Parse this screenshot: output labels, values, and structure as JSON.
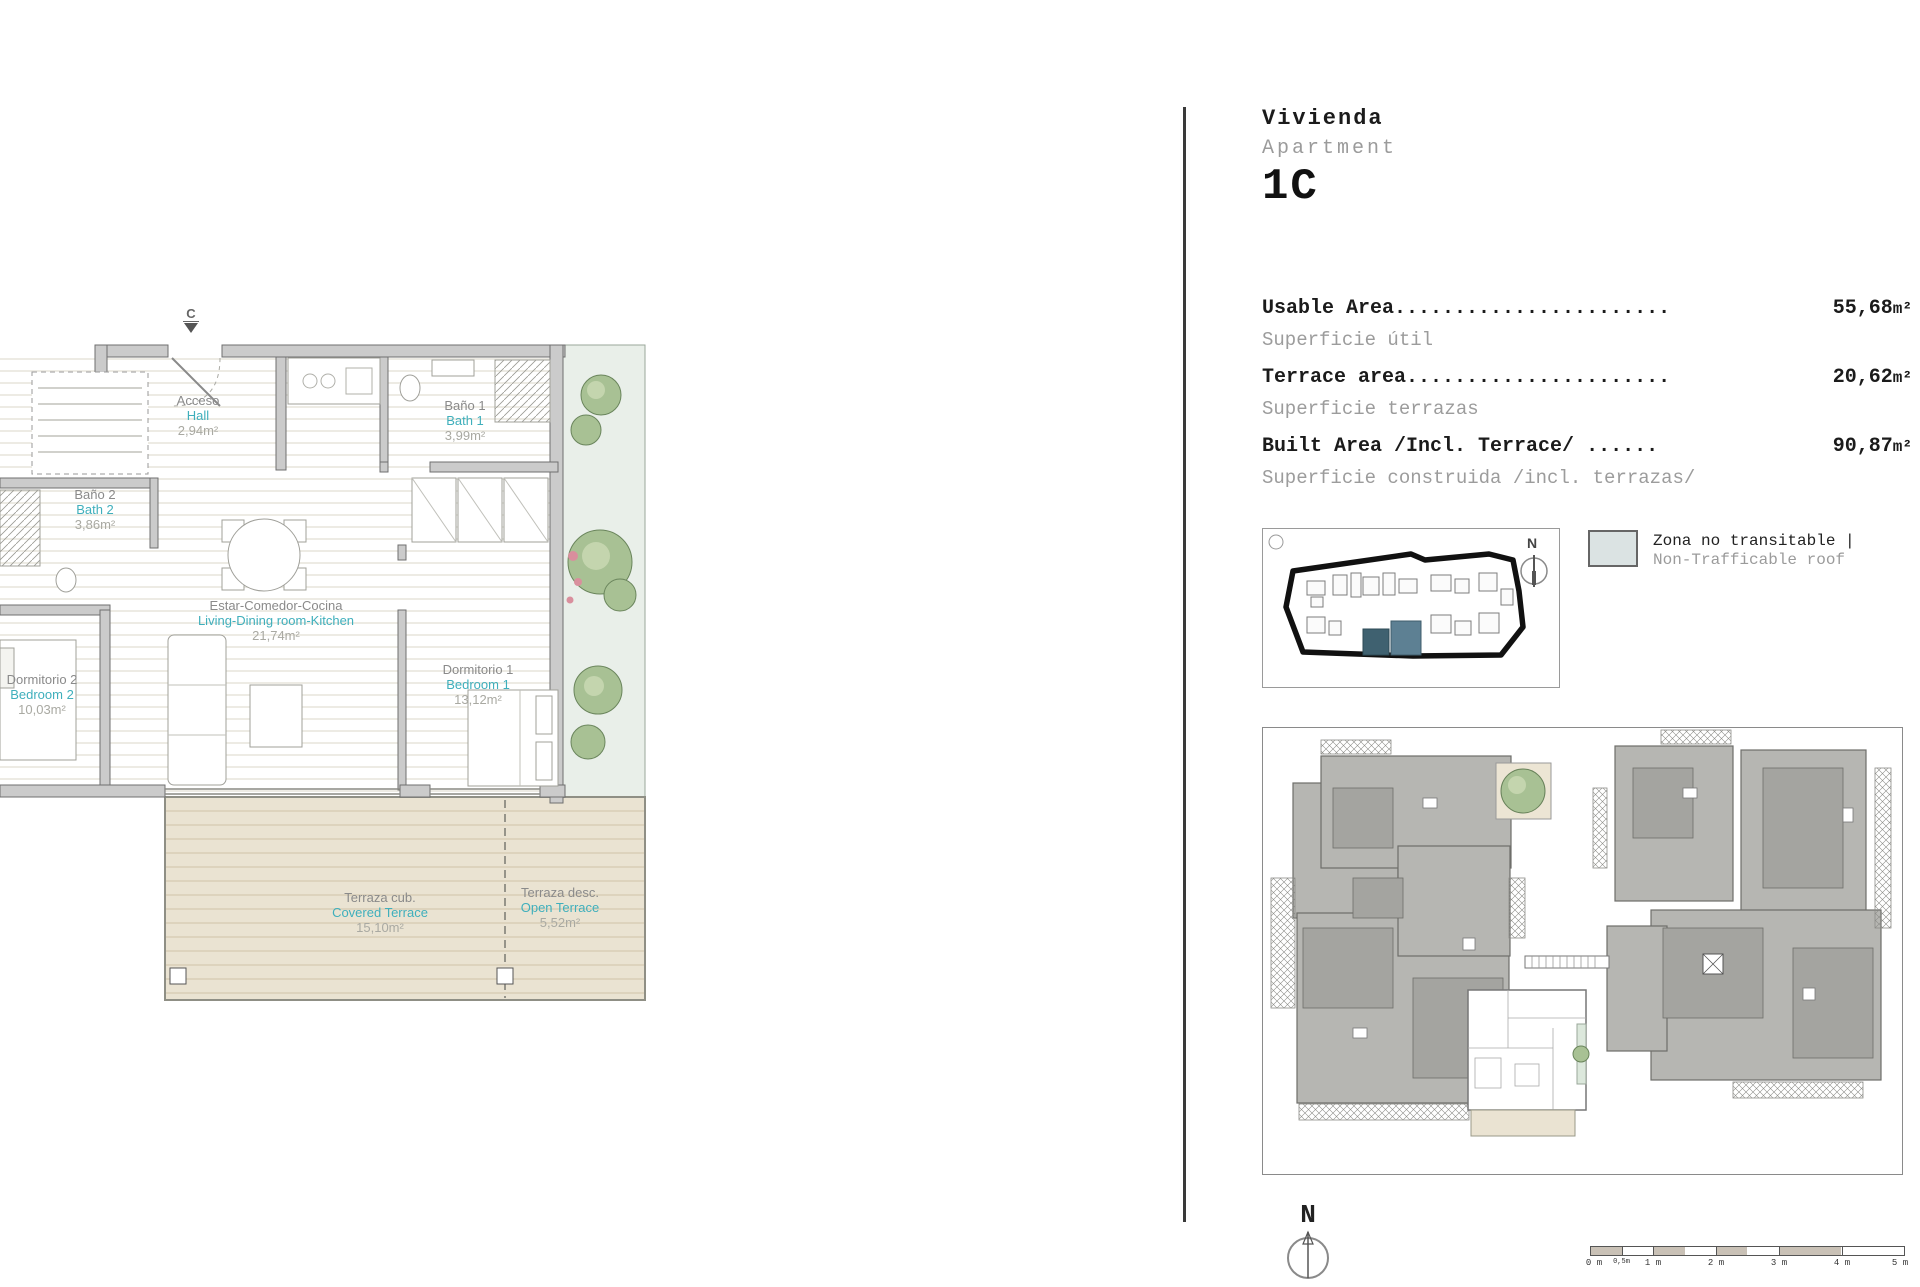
{
  "header": {
    "title_es": "Vivienda",
    "title_en": "Apartment",
    "unit_id": "1C"
  },
  "areas": [
    {
      "label_en": "Usable Area",
      "leader": ".......................",
      "value": "55,68",
      "unit": "m²",
      "label_es": "Superficie útil"
    },
    {
      "label_en": "Terrace area",
      "leader": "......................",
      "value": "20,62",
      "unit": "m²",
      "label_es": "Superficie terrazas"
    },
    {
      "label_en": "Built Area /Incl. Terrace/",
      "leader": "......",
      "value": "90,87",
      "unit": "m²",
      "label_es": "Superficie construida /incl. terrazas/"
    }
  ],
  "legend": {
    "line_es": "Zona no transitable |",
    "line_en": "Non-Trafficable roof",
    "swatch_color": "#dbe3e3"
  },
  "floor_plan": {
    "section_marker": "C",
    "rooms": [
      {
        "name_es": "Acceso",
        "name_en": "Hall",
        "area": "2,94m²"
      },
      {
        "name_es": "Baño 1",
        "name_en": "Bath 1",
        "area": "3,99m²"
      },
      {
        "name_es": "Baño 2",
        "name_en": "Bath 2",
        "area": "3,86m²"
      },
      {
        "name_es": "Estar-Comedor-Cocina",
        "name_en": "Living-Dining room-Kitchen",
        "area": "21,74m²"
      },
      {
        "name_es": "Dormitorio 2",
        "name_en": "Bedroom 2",
        "area": "10,03m²"
      },
      {
        "name_es": "Dormitorio 1",
        "name_en": "Bedroom 1",
        "area": "13,12m²"
      },
      {
        "name_es": "Terraza cub.",
        "name_en": "Covered Terrace",
        "area": "15,10m²"
      },
      {
        "name_es": "Terraza desc.",
        "name_en": "Open Terrace",
        "area": "5,52m²"
      }
    ]
  },
  "site_map": {
    "north": "N"
  },
  "compass": {
    "north": "N"
  },
  "scale_bar": {
    "labels": [
      "0 m",
      "0,5m",
      "1 m",
      "2 m",
      "3 m",
      "4 m",
      "5 m"
    ]
  },
  "colors": {
    "accent_teal": "#3fafbc",
    "muted_gray": "#8a8a8a",
    "wall_gray": "#cbcbcb",
    "terrace_beige": "#eae3d2",
    "site_highlight": "#3f6170",
    "roof_gray": "#b6b6b2"
  }
}
